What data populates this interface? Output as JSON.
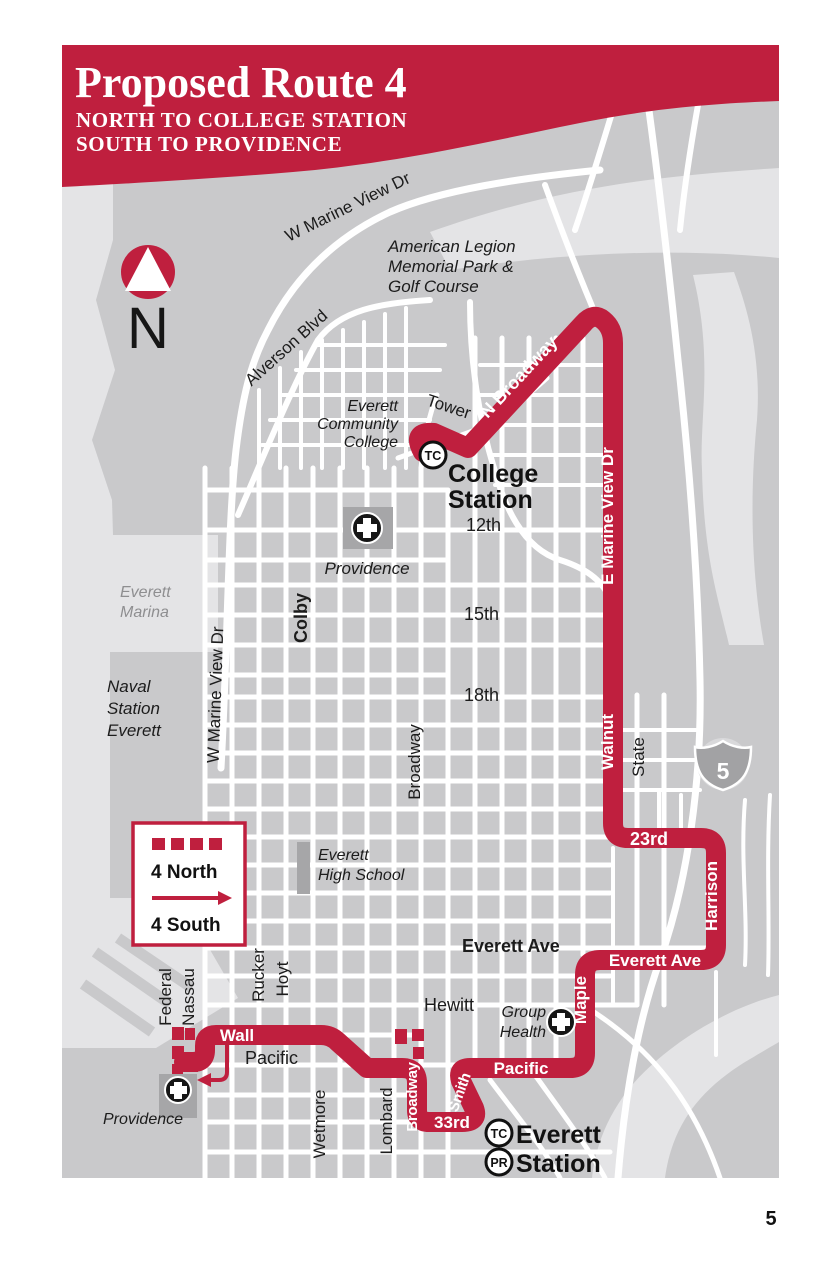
{
  "header": {
    "title": "Proposed Route 4",
    "subtitle1": "NORTH TO COLLEGE STATION",
    "subtitle2": "SOUTH TO PROVIDENCE"
  },
  "colors": {
    "route_red": "#bf1f3e",
    "map_gray": "#c9c9cb",
    "water_light_gray": "#e4e4e6",
    "building_gray": "#a6a6a8"
  },
  "compass": {
    "n": "N"
  },
  "legend": {
    "north": "4 North",
    "south": "4 South"
  },
  "page": {
    "number": "5"
  },
  "stations": {
    "college": {
      "badge": "TC",
      "line1": "College",
      "line2": "Station"
    },
    "everett": {
      "badge_tc": "TC",
      "badge_pr": "PR",
      "line1": "Everett",
      "line2": "Station"
    }
  },
  "route_streets": {
    "n_broadway": "N Broadway",
    "e_marine": "E Marine View Dr",
    "walnut": "Walnut",
    "rd23": "23rd",
    "harrison": "Harrison",
    "everett_ave": "Everett Ave",
    "maple": "Maple",
    "pacific": "Pacific",
    "broadway": "Broadway",
    "smith": "Smith",
    "rd33": "33rd",
    "wall": "Wall"
  },
  "streets": {
    "w_marine_top": "W Marine View Dr",
    "w_marine_left": "W Marine View Dr",
    "alverson": "Alverson Blvd",
    "tower": "Tower",
    "colby": "Colby",
    "broadway": "Broadway",
    "state": "State",
    "rd12": "12th",
    "rd15": "15th",
    "rd18": "18th",
    "rucker": "Rucker",
    "hoyt": "Hoyt",
    "federal": "Federal",
    "nassau": "Nassau",
    "wetmore": "Wetmore",
    "lombard": "Lombard",
    "hewitt": "Hewitt",
    "everett_ave": "Everett Ave",
    "pacific": "Pacific"
  },
  "places": {
    "american_legion": [
      "American Legion",
      "Memorial Park &",
      "Golf Course"
    ],
    "everett_cc": [
      "Everett",
      "Community",
      "College"
    ],
    "everett_marina": [
      "Everett",
      "Marina"
    ],
    "naval_station": [
      "Naval",
      "Station",
      "Everett"
    ],
    "everett_hs": [
      "Everett",
      "High School"
    ],
    "group_health": [
      "Group",
      "Health"
    ],
    "providence_north": "Providence",
    "providence_south": "Providence",
    "interstate": "5"
  }
}
